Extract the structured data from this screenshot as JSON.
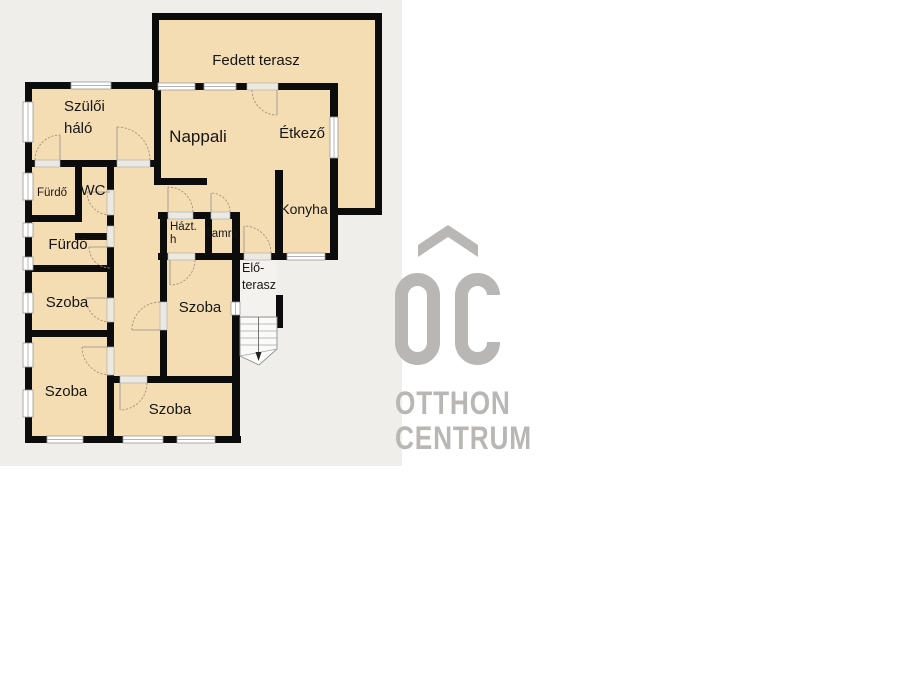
{
  "panel": {
    "color": "#efeeea"
  },
  "floorplan": {
    "rooms": {
      "fedett_terasz": "Fedett terasz",
      "szuloi_halo_line1": "Szülői",
      "szuloi_halo_line2": "háló",
      "nappali": "Nappali",
      "etkezo": "Étkező",
      "furdo_kis": "Fürdő",
      "wc": "WC",
      "furdo": "Fürdő",
      "konyha": "Konyha",
      "haztartasi_line1": "Házt.",
      "haztartasi_line2": "h",
      "kamra": "Kamra",
      "elo_terasz_line1": "Elő-",
      "elo_terasz_line2": "terasz",
      "szoba_bal_felso": "Szoba",
      "szoba_kozepso": "Szoba",
      "szoba_bal_also": "Szoba",
      "szoba_also": "Szoba"
    },
    "colors": {
      "room_fill": "#f4ddb3",
      "wall": "#0c0c0c",
      "window": "#ffffff",
      "door_arc": "#a5937a",
      "terrace_floor": "#f3f2ee"
    }
  },
  "logo": {
    "monogram": "OC",
    "line1": "OTTHON",
    "line2": "CENTRUM",
    "color": "#b8b7b5"
  }
}
